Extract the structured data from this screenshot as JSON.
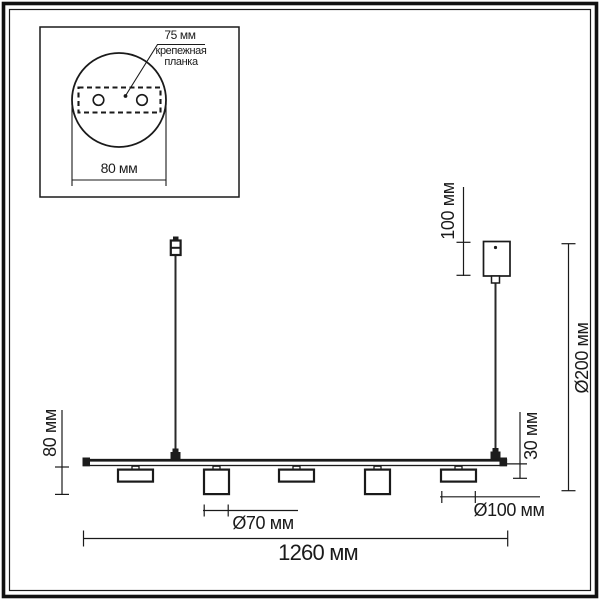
{
  "drawing": {
    "description": "Dimensional line drawing of a linear pendant light with 5 spot heads, two suspension cables and a ceiling canopy",
    "colors": {
      "line": "#1a1a1a",
      "cable": "#2a2a2a",
      "background": "#ffffff"
    },
    "inset": {
      "hole_spacing_label": "75 мм",
      "plate_label_line1": "крепежная",
      "plate_label_line2": "планка",
      "canopy_width_label": "80 мм"
    },
    "dimensions": {
      "canopy_height_label": "100 мм",
      "overall_height_label": "Ø200 мм",
      "puck_height_label": "30 мм",
      "spot_drop_label": "80 мм",
      "spot_diameter_label": "Ø70 мм",
      "puck_diameter_label": "Ø100 мм",
      "bar_length_label": "1260 мм"
    }
  }
}
